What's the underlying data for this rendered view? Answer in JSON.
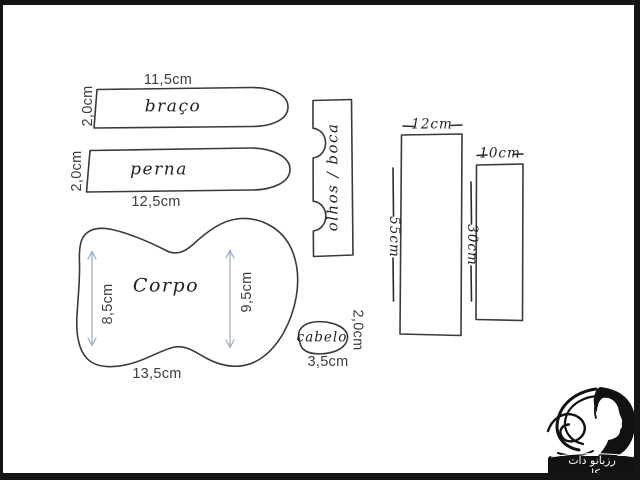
{
  "pattern": {
    "braco": {
      "name": "braço",
      "width": "11,5cm",
      "height": "2,0cm"
    },
    "perna": {
      "name": "perna",
      "width": "12,5cm",
      "height": "2,0cm"
    },
    "corpo": {
      "name": "Corpo",
      "left_height": "8,5cm",
      "right_height": "9,5cm",
      "width": "13,5cm"
    },
    "olhos_boca": {
      "name": "olhos / boca"
    },
    "cabelo": {
      "name": "cabelo",
      "height": "2,0cm",
      "width": "3,5cm"
    },
    "rect_large": {
      "width": "12cm",
      "height": "55cm"
    },
    "rect_small": {
      "width": "10cm",
      "height": "30cm"
    }
  },
  "watermark": {
    "site": "رزبانو دات کام"
  },
  "colors": {
    "outline": "#3a3a3a",
    "printed_text": "#3d3d3d",
    "handwritten_text": "#1f1f1f",
    "arrow": "#9db1c7",
    "frame": "#141414",
    "watermark_bg": "#111111",
    "watermark_fg": "#ffffff"
  }
}
